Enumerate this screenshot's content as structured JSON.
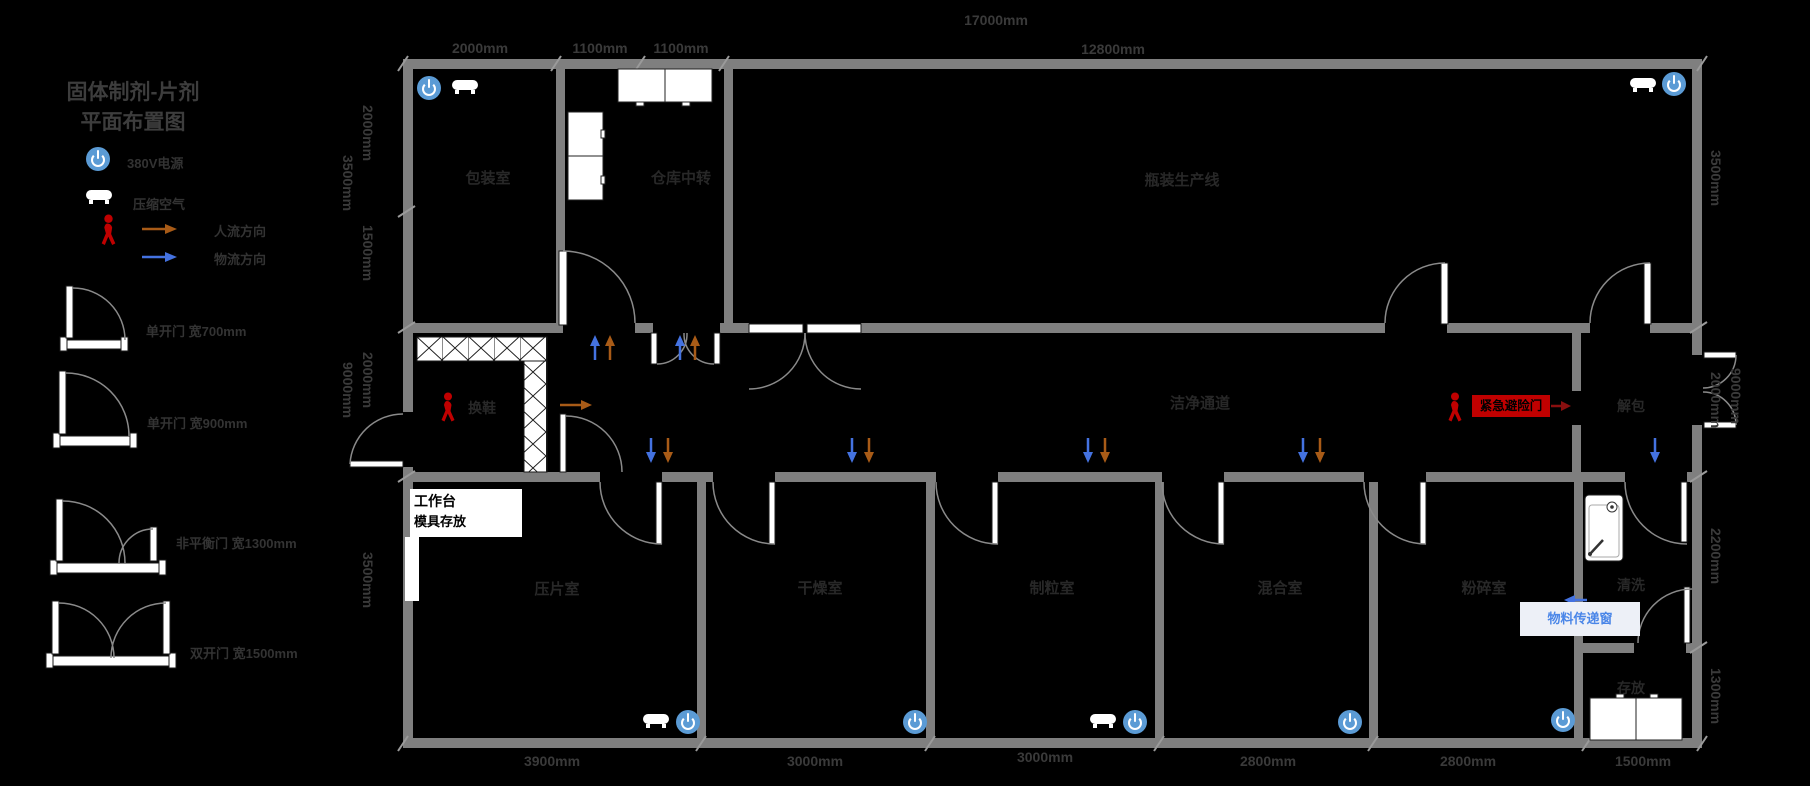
{
  "title": {
    "line1": "固体制剂-片剂",
    "line2": "平面布置图"
  },
  "legend": {
    "power_label": "380V电源",
    "air_label": "压缩空气",
    "people_flow_label": "人流方向",
    "material_flow_label": "物流方向",
    "door_single_700": "单开门  宽700mm",
    "door_single_900": "单开门  宽900mm",
    "door_unbalanced_1300": "非平衡门  宽1300mm",
    "door_double_1500": "双开门  宽1500mm"
  },
  "rooms": {
    "packaging": "包装室",
    "warehouse_transfer": "仓库中转",
    "bottling_line": "瓶装生产线",
    "shoe_change": "换鞋",
    "clean_corridor": "洁净通道",
    "unpacking": "解包",
    "tablet_press": "压片室",
    "drying": "干燥室",
    "granulation": "制粒室",
    "mixing": "混合室",
    "crushing": "粉碎室",
    "washing": "清洗",
    "storage": "存放"
  },
  "annotations": {
    "workbench_line1": "工作台",
    "workbench_line2": "模具存放",
    "emergency_exit": "紧急避险门",
    "transfer_window": "物料传递窗"
  },
  "dimensions": {
    "top_total": "17000mm",
    "top": [
      "2000mm",
      "1100mm",
      "1100mm",
      "12800mm"
    ],
    "bottom": [
      "3900mm",
      "3000mm",
      "3000mm",
      "2800mm",
      "2800mm",
      "1500mm"
    ],
    "left_inner": [
      "2000mm",
      "1500mm",
      "2000mm",
      "3500mm"
    ],
    "left_outer": [
      "3500mm",
      "9000mm"
    ],
    "right_inner": [
      "3500mm",
      "2000mm",
      "2200mm",
      "1300mm"
    ],
    "right_outer": [
      "9000mm"
    ]
  },
  "colors": {
    "background": "#000000",
    "wall": "#7f7f7f",
    "power_blue": "#5b9bd5",
    "people_flow_orange": "#a85b17",
    "material_flow_blue": "#4472e0",
    "alert_red": "#c00000",
    "transfer_blue": "#4a86e8"
  }
}
